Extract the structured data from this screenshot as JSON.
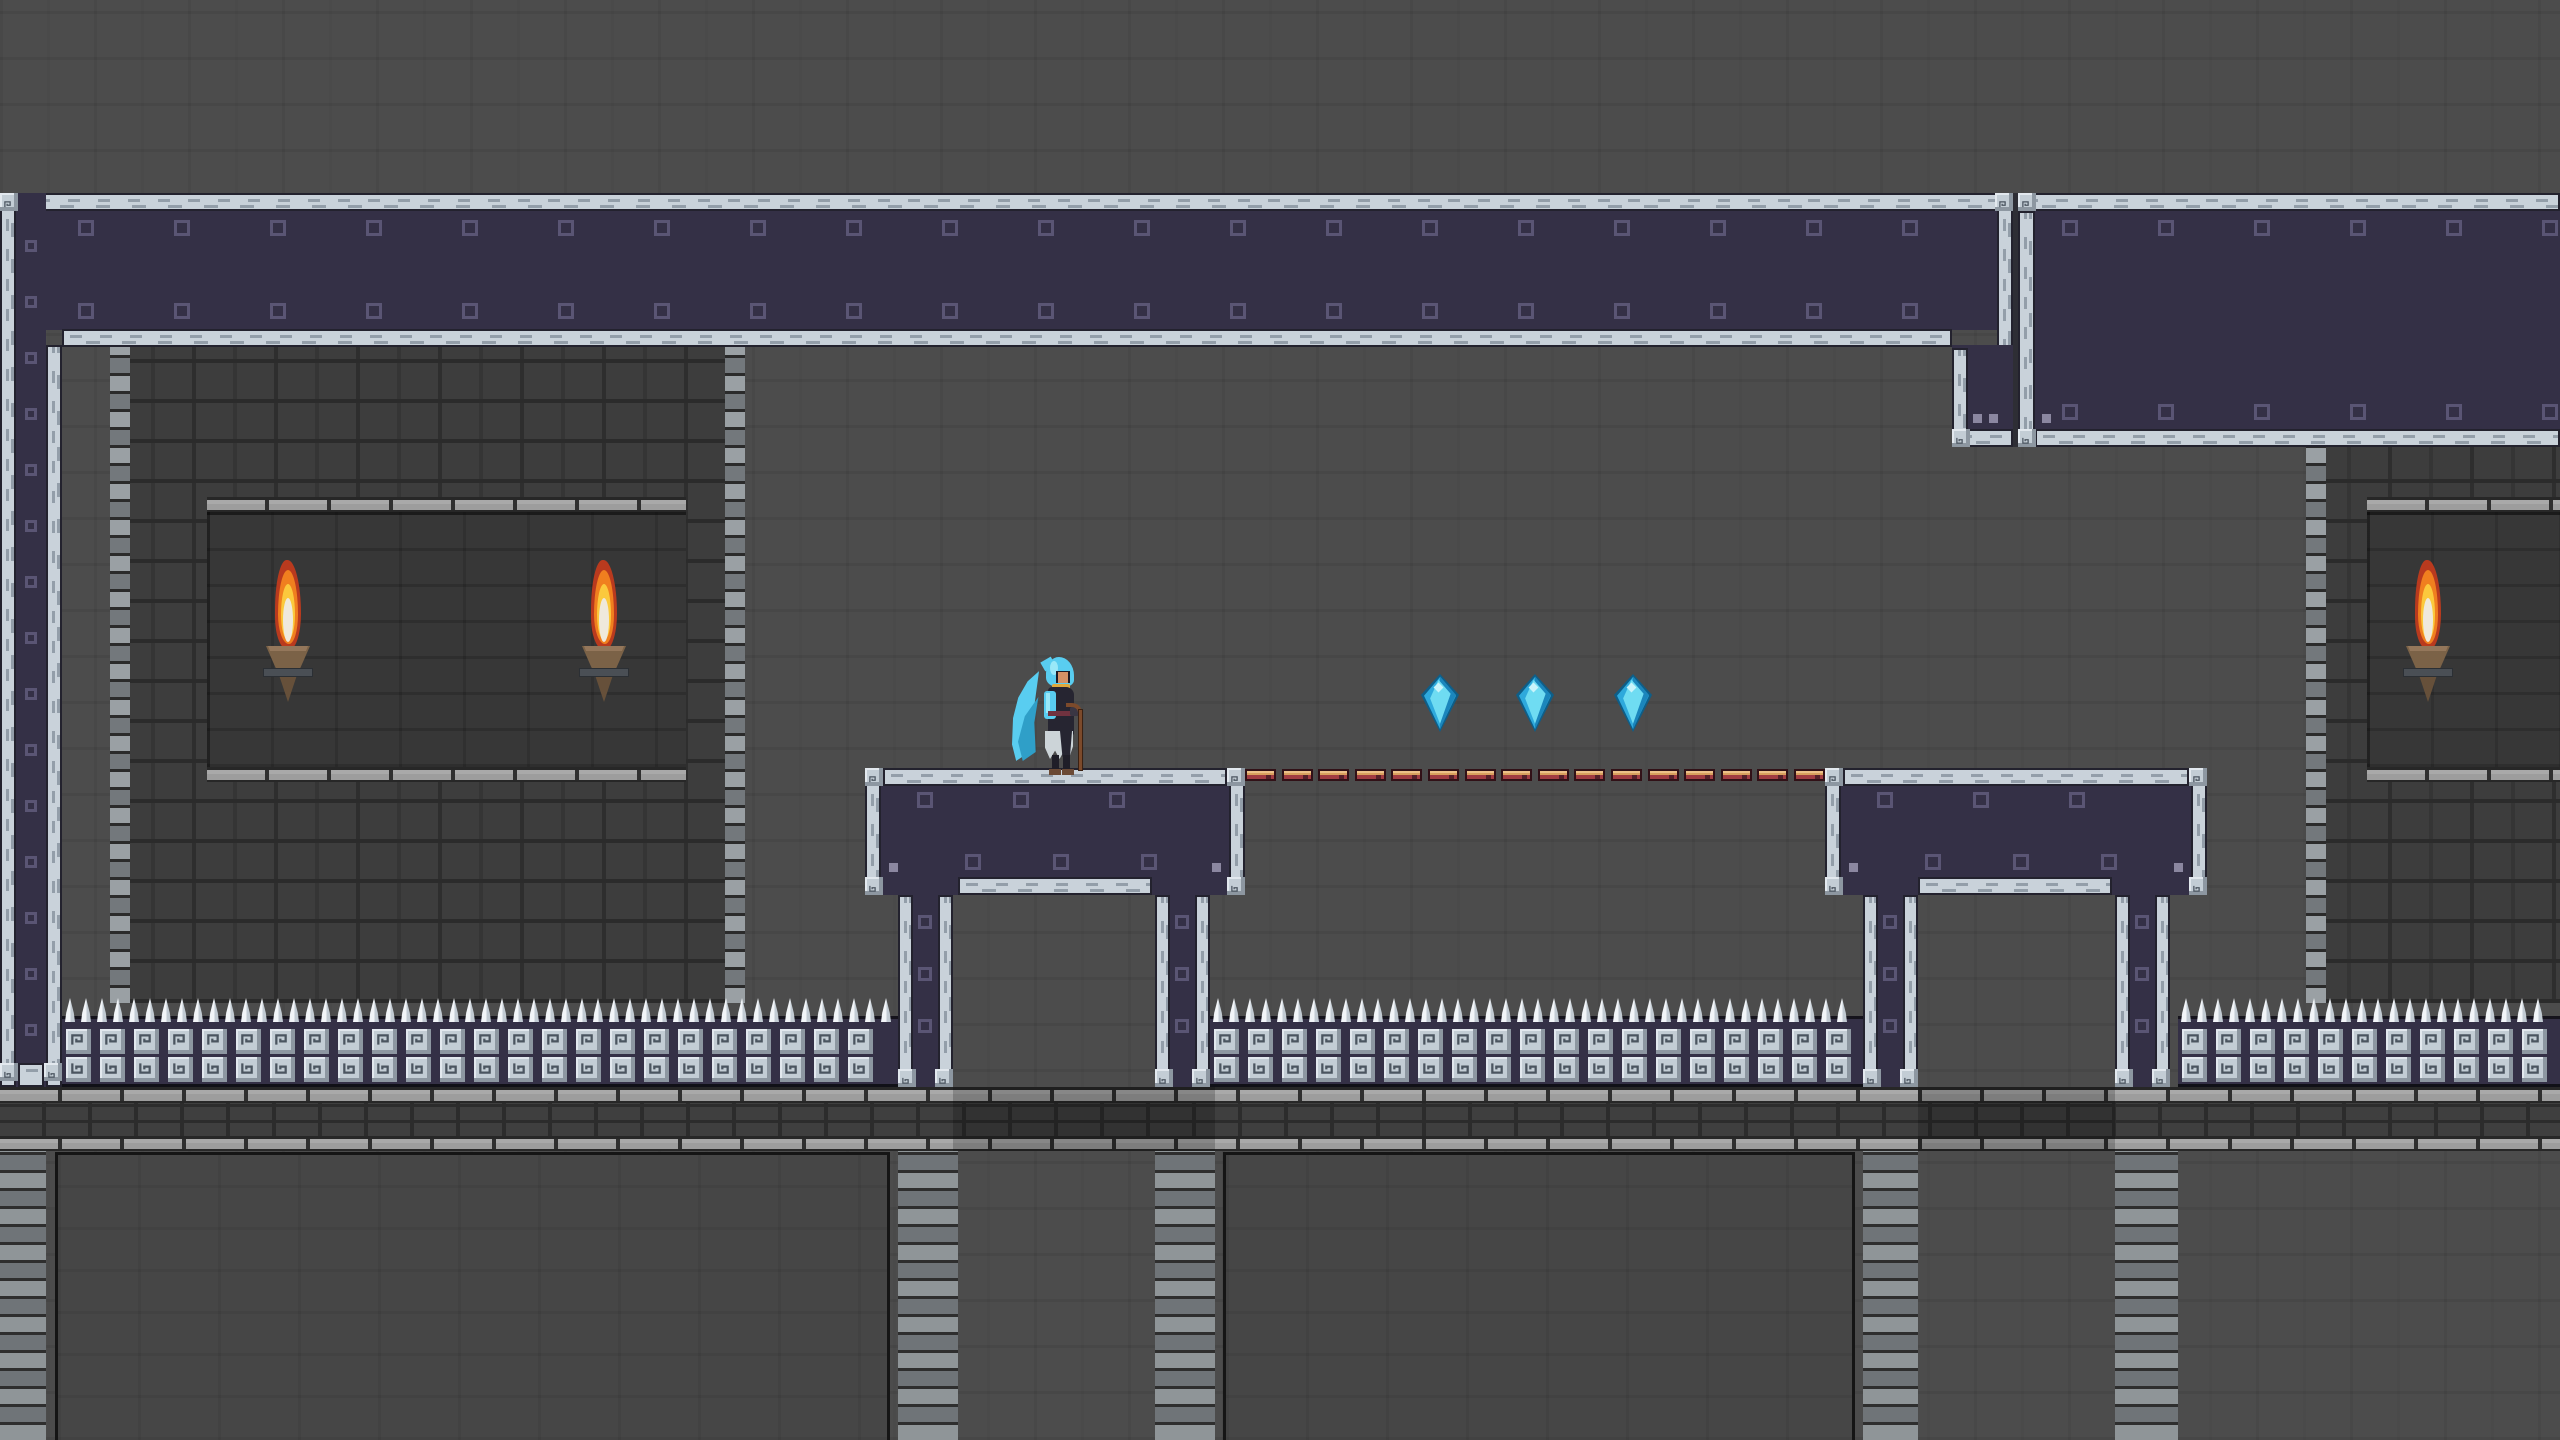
{
  "app": {
    "type": "2d-pixel-platformer-game",
    "view": "stone-dungeon-room",
    "resolution": "2560x1440",
    "visible_text": "none"
  },
  "colors": {
    "background": "#4c4c4c",
    "wall": "#3d3d3d",
    "wall_mortar": "#2b2b2b",
    "window_inset": "#373737",
    "navy_panel": "#343046",
    "navy_border": "#15131c",
    "stud": "#5a5574",
    "beam": "#c9d2da",
    "beam_dash": "#939ea9",
    "tile_face": "#c3cdd5",
    "tile_shadow": "#8d97a1",
    "tile_glyph": "#4b5560",
    "spike": "#f2f5f8",
    "course_light": "#9d9d9d",
    "course_dark": "#3f3f3f",
    "floor_panel": "#464646",
    "torch_red": "#b93a1e",
    "torch_orange": "#f07f1f",
    "torch_yellow": "#fbc93d",
    "torch_core": "#efe9dc",
    "torch_cup": "#7b6247",
    "torch_cone": "#66503a",
    "torch_band": "#4a4f55",
    "gem_dark": "#0e5e88",
    "gem_base": "#2ea9dc",
    "gem_facet": "#1b86bc",
    "gem_light": "#6fdcf2",
    "gem_spark": "#c9f4fb",
    "bar_body": "#a13c42",
    "bar_top": "#d9a05e",
    "bar_top_hi": "#ecc088",
    "bar_notch": "#55202a",
    "bar_edge": "#311117",
    "player_cape": "#59cdf0",
    "player_cape_hi": "#9ae8f8",
    "player_cape_sh": "#2f9fc8",
    "player_robe": "#262531",
    "player_hood_inner": "#1d1c26",
    "player_skin": "#d49266",
    "player_gold": "#e0a93c",
    "player_skirt": "#ccd4d8",
    "player_belt": "#70323f",
    "player_leg": "#1f1e28",
    "player_boot": "#6b4a35",
    "player_staff": "#7c4a2b",
    "player_glove": "#3a3643"
  },
  "scene": {
    "viewport": {
      "w": 2560,
      "h": 1440
    },
    "entities_summary": {
      "player": {
        "label": "hooded mage with staff",
        "count": 1
      },
      "crystal_gems": {
        "count": 3
      },
      "wall_torches": {
        "count": 3
      },
      "bridge_bars": {
        "count": 16
      },
      "spike_fence_bays": {
        "count": 3
      },
      "platforms": {
        "count": 2
      }
    },
    "ceiling_band_left": {
      "x": 0,
      "y": 193,
      "w": 2013,
      "navy_y": 210,
      "navy_h": 120,
      "bottom_beam": {
        "x": 62,
        "y": 329,
        "w": 1890
      },
      "right_beam_x": 1997,
      "endcap": {
        "x": 1952,
        "y": 345,
        "w": 61,
        "bottom_y": 429
      }
    },
    "seam": {
      "x": 2013,
      "y": 193,
      "w": 5,
      "h": 254
    },
    "ceiling_band_right": {
      "x": 2018,
      "y": 193,
      "w": 542,
      "navy_y": 211,
      "navy_h": 218,
      "bottom_y": 429
    },
    "left_column": {
      "beam1_x": 0,
      "navy_x": 16,
      "navy_w": 30,
      "beam2_x": 46,
      "beam2_y": 345,
      "top_y": 193,
      "bottom_y": 1087
    },
    "walls": [
      {
        "id": "wall-left",
        "x": 110,
        "y": 345,
        "w": 635,
        "h": 658,
        "window": {
          "x": 207,
          "y": 497,
          "w": 479,
          "h": 285
        },
        "torch_xs": [
          266,
          582
        ]
      },
      {
        "id": "wall-right",
        "x": 2306,
        "y": 443,
        "w": 254,
        "h": 560,
        "window": {
          "x": 2367,
          "y": 497,
          "w": 193,
          "h": 285
        },
        "torch_xs": [
          2406
        ]
      }
    ],
    "torch": {
      "w": 44,
      "h": 142,
      "y": 560
    },
    "platforms": [
      {
        "x": 865,
        "y": 768,
        "w": 380,
        "legs": [
          898,
          1155
        ]
      },
      {
        "x": 1825,
        "y": 768,
        "w": 382,
        "legs": [
          1863,
          2115
        ]
      }
    ],
    "platform": {
      "body_h": 127,
      "leg_w": 55,
      "leg_bottom": 1087
    },
    "bridge": {
      "x": 1245,
      "y": 769,
      "w": 580,
      "segments": 16,
      "seg_w": 31,
      "seg_h": 12
    },
    "gems": [
      {
        "cx": 1440,
        "cy": 703
      },
      {
        "cx": 1535,
        "cy": 703
      },
      {
        "cx": 1633,
        "cy": 703
      }
    ],
    "gem": {
      "w": 38,
      "h": 58
    },
    "player": {
      "x": 1012,
      "y": 657,
      "w": 78,
      "h": 118
    },
    "fence": {
      "spike_y": 998,
      "band_y": 1016,
      "band_h": 71,
      "tile_row1_y": 1029,
      "tile_row2_y": 1057,
      "bays": [
        [
          62,
          898
        ],
        [
          1210,
          1863
        ],
        [
          2178,
          2560
        ]
      ]
    },
    "ledge": {
      "y": 1087,
      "h": 64,
      "shadow_spans": [
        [
          953,
          1215
        ],
        [
          1918,
          2115
        ]
      ]
    },
    "bottom": {
      "y": 1151,
      "panels": [
        [
          55,
          890
        ],
        [
          1223,
          1855
        ]
      ],
      "columns": [
        [
          0,
          46
        ],
        [
          898,
          958
        ],
        [
          1155,
          1215
        ],
        [
          1863,
          1918
        ],
        [
          2115,
          2178
        ]
      ]
    }
  }
}
